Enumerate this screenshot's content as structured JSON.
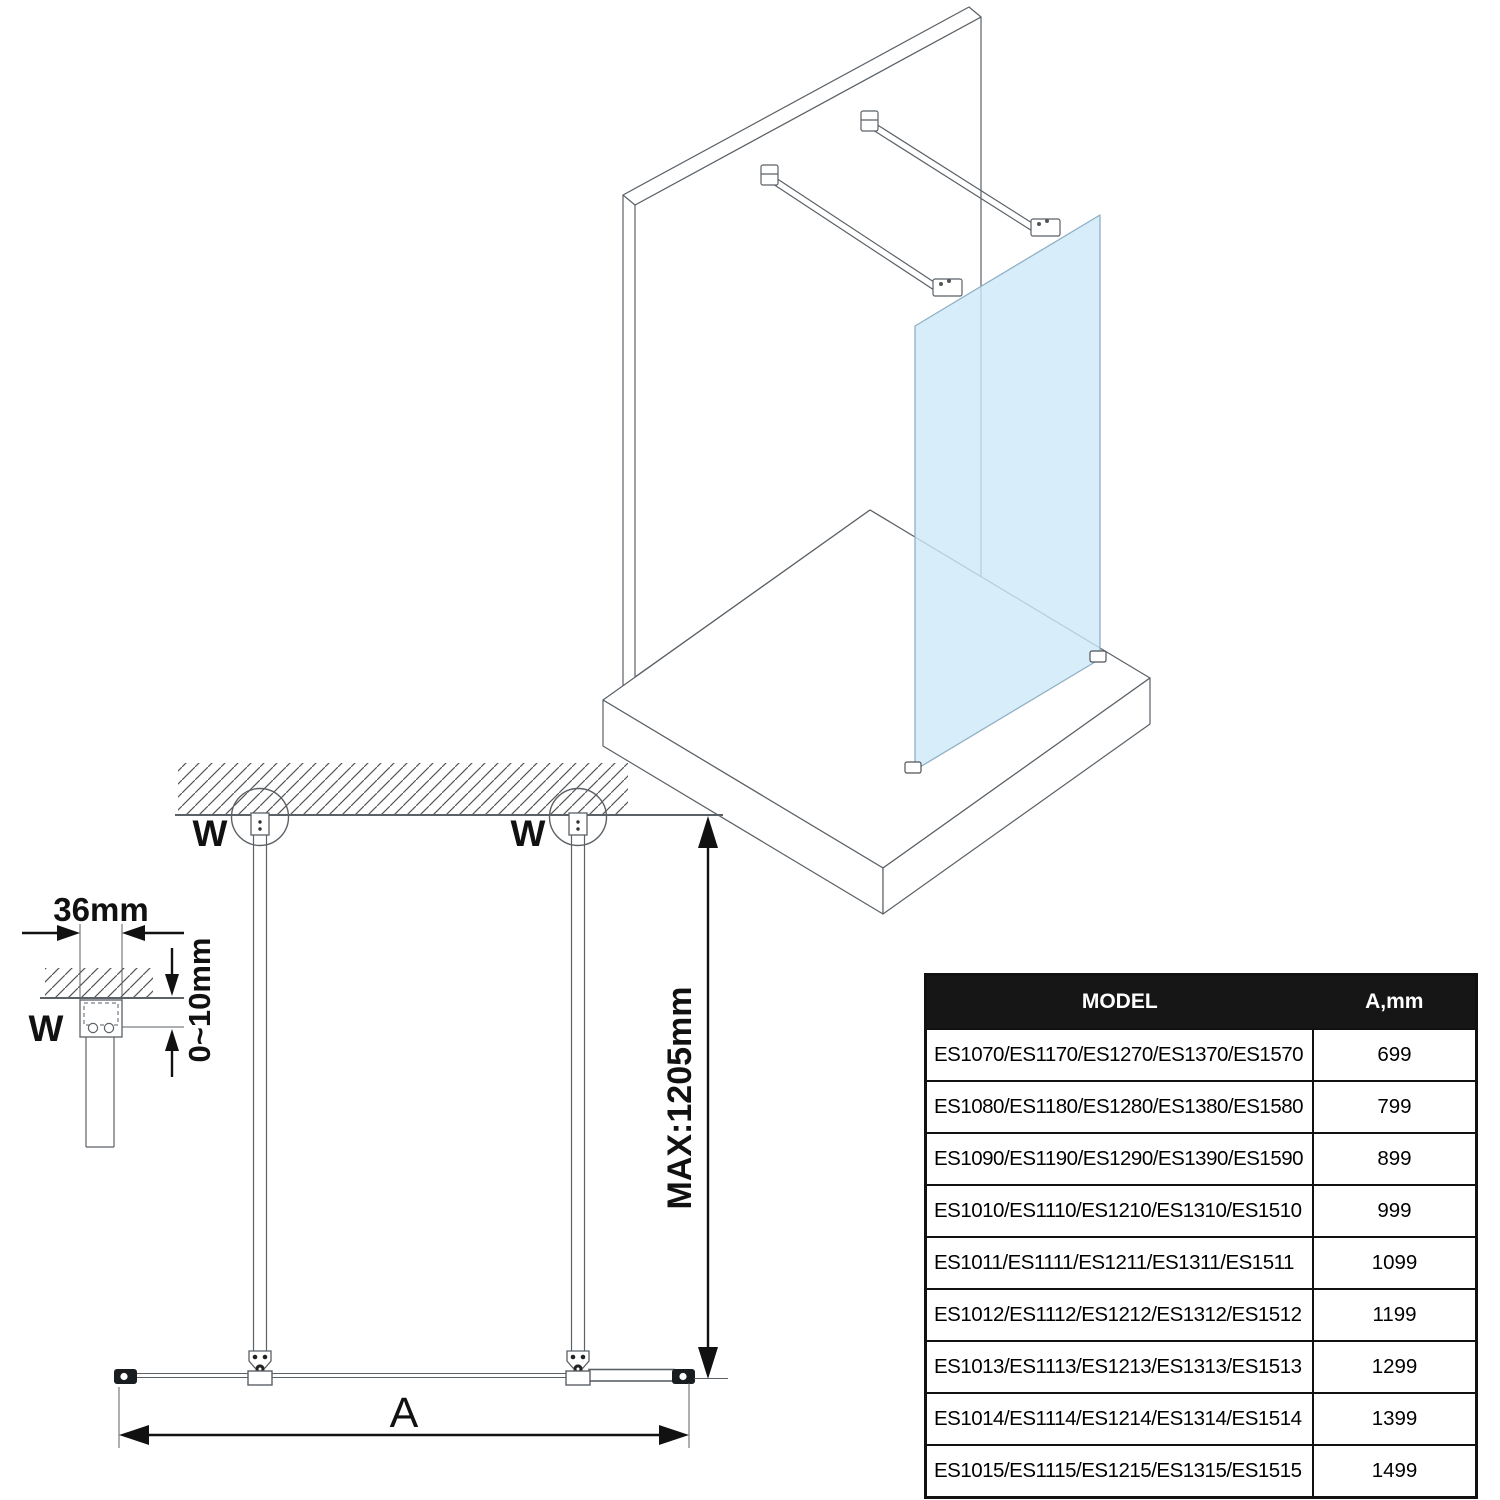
{
  "drawing": {
    "line_color": "#5a6167",
    "dark_color": "#1a1d20",
    "glass_color": "#cde9f8",
    "labels": {
      "wall_marker": "W",
      "bracket_width": "36mm",
      "adjust_range": "0~10mm",
      "max_height": "MAX:1205mm",
      "width_dim": "A"
    }
  },
  "table": {
    "headers": {
      "model": "MODEL",
      "a_mm": "A,mm"
    },
    "rows": [
      {
        "model": "ES1070/ES1170/ES1270/ES1370/ES1570",
        "a": "699"
      },
      {
        "model": "ES1080/ES1180/ES1280/ES1380/ES1580",
        "a": "799"
      },
      {
        "model": "ES1090/ES1190/ES1290/ES1390/ES1590",
        "a": "899"
      },
      {
        "model": "ES1010/ES1110/ES1210/ES1310/ES1510",
        "a": "999"
      },
      {
        "model": "ES1011/ES1111/ES1211/ES1311/ES1511",
        "a": "1099"
      },
      {
        "model": "ES1012/ES1112/ES1212/ES1312/ES1512",
        "a": "1199"
      },
      {
        "model": "ES1013/ES1113/ES1213/ES1313/ES1513",
        "a": "1299"
      },
      {
        "model": "ES1014/ES1114/ES1214/ES1314/ES1514",
        "a": "1399"
      },
      {
        "model": "ES1015/ES1115/ES1215/ES1315/ES1515",
        "a": "1499"
      }
    ]
  }
}
